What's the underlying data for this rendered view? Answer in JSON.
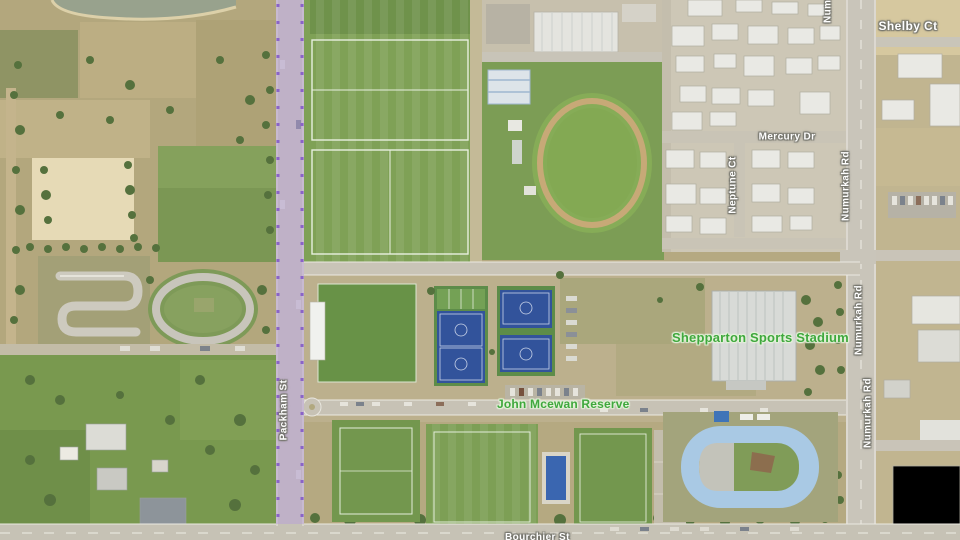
{
  "map": {
    "view_type": "satellite",
    "street_labels": [
      {
        "id": "shelby-ct",
        "text": "Shelby Ct",
        "orientation": "horizontal"
      },
      {
        "id": "mercury-dr",
        "text": "Mercury Dr",
        "orientation": "horizontal"
      },
      {
        "id": "neptune-ct",
        "text": "Neptune Ct",
        "orientation": "vertical"
      },
      {
        "id": "numurkah-rd-north",
        "text": "Numurkah Rd",
        "orientation": "vertical"
      },
      {
        "id": "numurkah-rd-mid",
        "text": "Numurkah Rd",
        "orientation": "vertical"
      },
      {
        "id": "numurkah-rd-south",
        "text": "Numurkah Rd",
        "orientation": "vertical"
      },
      {
        "id": "numurkah-rd-top-partial",
        "text": "Numurkah Rd",
        "orientation": "vertical",
        "partial": true
      },
      {
        "id": "packham-st",
        "text": "Packham St",
        "orientation": "vertical"
      },
      {
        "id": "bottom-street-partial",
        "text": "Bourchier St",
        "orientation": "horizontal",
        "partial": true
      }
    ],
    "place_labels": [
      {
        "id": "shepparton-sports-stadium",
        "text": "Shepparton Sports Stadium"
      },
      {
        "id": "john-mcewan-reserve",
        "text": "John Mcewan Reserve"
      }
    ],
    "route": {
      "highlighted_street": "Packham St",
      "highlight_fill": "#b8a0d8",
      "highlight_dot_color": "#8a63c8"
    },
    "colors": {
      "place_label_green": "#3fa83d",
      "street_label_white": "#ffffff",
      "street_label_halo": "#74746c",
      "field_green": "#7a9c53",
      "dry_grass_tan": "#b5a981",
      "road_gray": "#c8c4b8",
      "court_blue": "#32539b",
      "velodrome_track_blue": "#a9c9e4",
      "sand_arena": "#e6dab6"
    }
  }
}
